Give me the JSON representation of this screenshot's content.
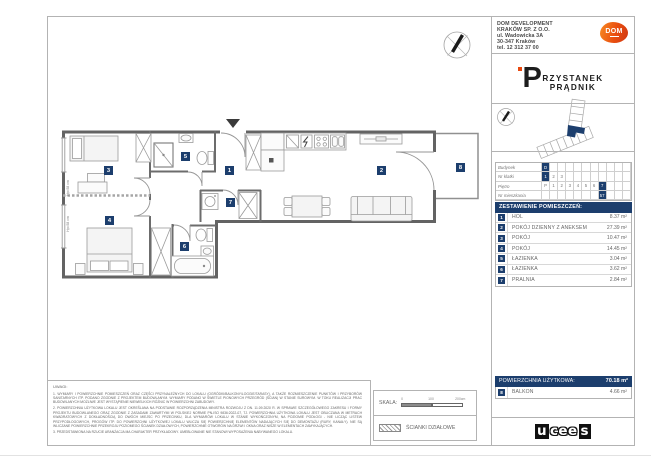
{
  "company": {
    "line1": "DOM DEVELOPMENT",
    "line2": "KRAKÓW SP. Z O.O.",
    "line3": "ul. Wadowicka 3A",
    "line4": "30-347 Kraków",
    "line5": "tel. 12 312 37 00",
    "logo_text": "DOM"
  },
  "project": {
    "logo_initial": "P",
    "logo_rest": "RZYSTANEK",
    "logo_line2": "PRĄDNIK"
  },
  "unit_table": {
    "rows": [
      {
        "label": "Budynek",
        "cells": [
          "D"
        ]
      },
      {
        "label": "Nr klatki",
        "cells": [
          "1",
          "2",
          "3"
        ]
      },
      {
        "label": "Piętro",
        "cells": [
          "P",
          "1",
          "2",
          "3",
          "4",
          "5",
          "6",
          "7"
        ]
      },
      {
        "label": "Nr mieszkania",
        "cells": [
          "57"
        ]
      }
    ]
  },
  "rooms_header": "ZESTAWIENIE POMIESZCZEŃ:",
  "rooms": [
    {
      "num": "1",
      "name": "HOL",
      "area": "8.37 m²"
    },
    {
      "num": "2",
      "name": "POKÓJ DZIENNY Z ANEKSEM",
      "area": "27.39 m²"
    },
    {
      "num": "3",
      "name": "POKÓJ",
      "area": "10.47 m²"
    },
    {
      "num": "4",
      "name": "POKÓJ",
      "area": "14.45 m²"
    },
    {
      "num": "5",
      "name": "ŁAZIENKA",
      "area": "3.04 m²"
    },
    {
      "num": "6",
      "name": "ŁAZIENKA",
      "area": "3.62 m²"
    },
    {
      "num": "7",
      "name": "PRALNIA",
      "area": "2.84 m²"
    }
  ],
  "summary": {
    "label": "POWIERZCHNIA UŻYTKOWA:",
    "value": "70.18 m²"
  },
  "balcony": {
    "num": "8",
    "name": "BALKON",
    "area": "4.66 m²"
  },
  "plan": {
    "window_sill_label": "Hp=58 cm"
  },
  "notes": {
    "title": "UWAGI:",
    "items": [
      "1. WYMIARY I POWIERZCHNIE POMIESZCZEŃ ORAZ CZĘŚCI PRZYNALEŻNYCH DO LOKALU (OGRÓDKI/BALKONY/LOGGIE/TARASY), A TAKŻE ROZMIESZCZENIE PUNKTÓW I PRZYBORÓW SANITARNYCH ITP. PODANO ZGODNIE Z PROJEKTEM BUDOWLANYM. WYMIARY PODANO W ŚWIETLE PIONOWYCH PRZEGRÓD (ŚCIAN) W STANIE SUROWYM. W TOKU REALIZACJI PRAC BUDOWLANYCH MOŻLIWE JEST WYSTĄPIENIE NIEWIELKICH RÓŻNIC W POWIERZCHNI ZABUDOWY.",
      "2. POWIERZCHNIA UŻYTKOWA LOKALU JEST OKREŚLANA NA PODSTAWIE ROZPORZĄDZENIA MINISTRA ROZWOJU Z DN. 11.09.2020 R. W SPRAWIE SZCZEGÓŁOWEGO ZAKRESU I FORMY PROJEKTU BUDOWLANEGO ORAZ ZGODNIE Z ZASADAMI ZAWARTYMI W POLSKIEJ NORMIE PN-ISO 9836:2022-07, TJ. POWIERZCHNIA UŻYTKOWA LOKALU JEST OBLICZANA W METRACH KWADRATOWYCH Z DOKŁADNOŚCIĄ DO DWÓCH MIEJSC PO PRZECINKU, DLA WYMIARÓW LOKALU W STANIE WYKOŃCZONYM, NA POZIOMIE PODŁOGI - NIE LICZĄC LISTEW PRZYPODŁOGOWYCH, PROGÓW ITP. DO POWIERZCHNI UŻYTKOWEJ LOKALU WLICZA SIĘ POWIERZCHNIĘ ELEMENTÓW NADAJĄCYCH SIĘ DO DEMONTAŻU (RURY, KANAŁY). NIE SĄ WLICZANE POWIERZCHNIE PRZEKROJU POZIOMEGO ŚCIANEK DZIAŁOWYCH, POWIERZCHNIE OTWORÓW NA DRZWI I OKNA ORAZ NISZE W ELEMENTACH ZAMYKAJĄCYCH.",
      "3. PRZEDSTAWIONA NA RZUCIE ARANŻACJA MA CHARAKTER PRZYKŁADOWY. UMEBLOWANIE NIE STANOWI WYPOSAŻENIA NABYWANEGO LOKALU."
    ]
  },
  "scale": {
    "label": "SKALA:",
    "tick0": "0",
    "tick1": "100",
    "tick2": "200cm"
  },
  "legend": {
    "partition_label": "ŚCIANKI DZIAŁOWE"
  },
  "footer_logo": {
    "part1": "u",
    "part2": "cee",
    "part3": "s"
  },
  "colors": {
    "navy": "#1c3e6d",
    "orange": "#e8490f"
  }
}
